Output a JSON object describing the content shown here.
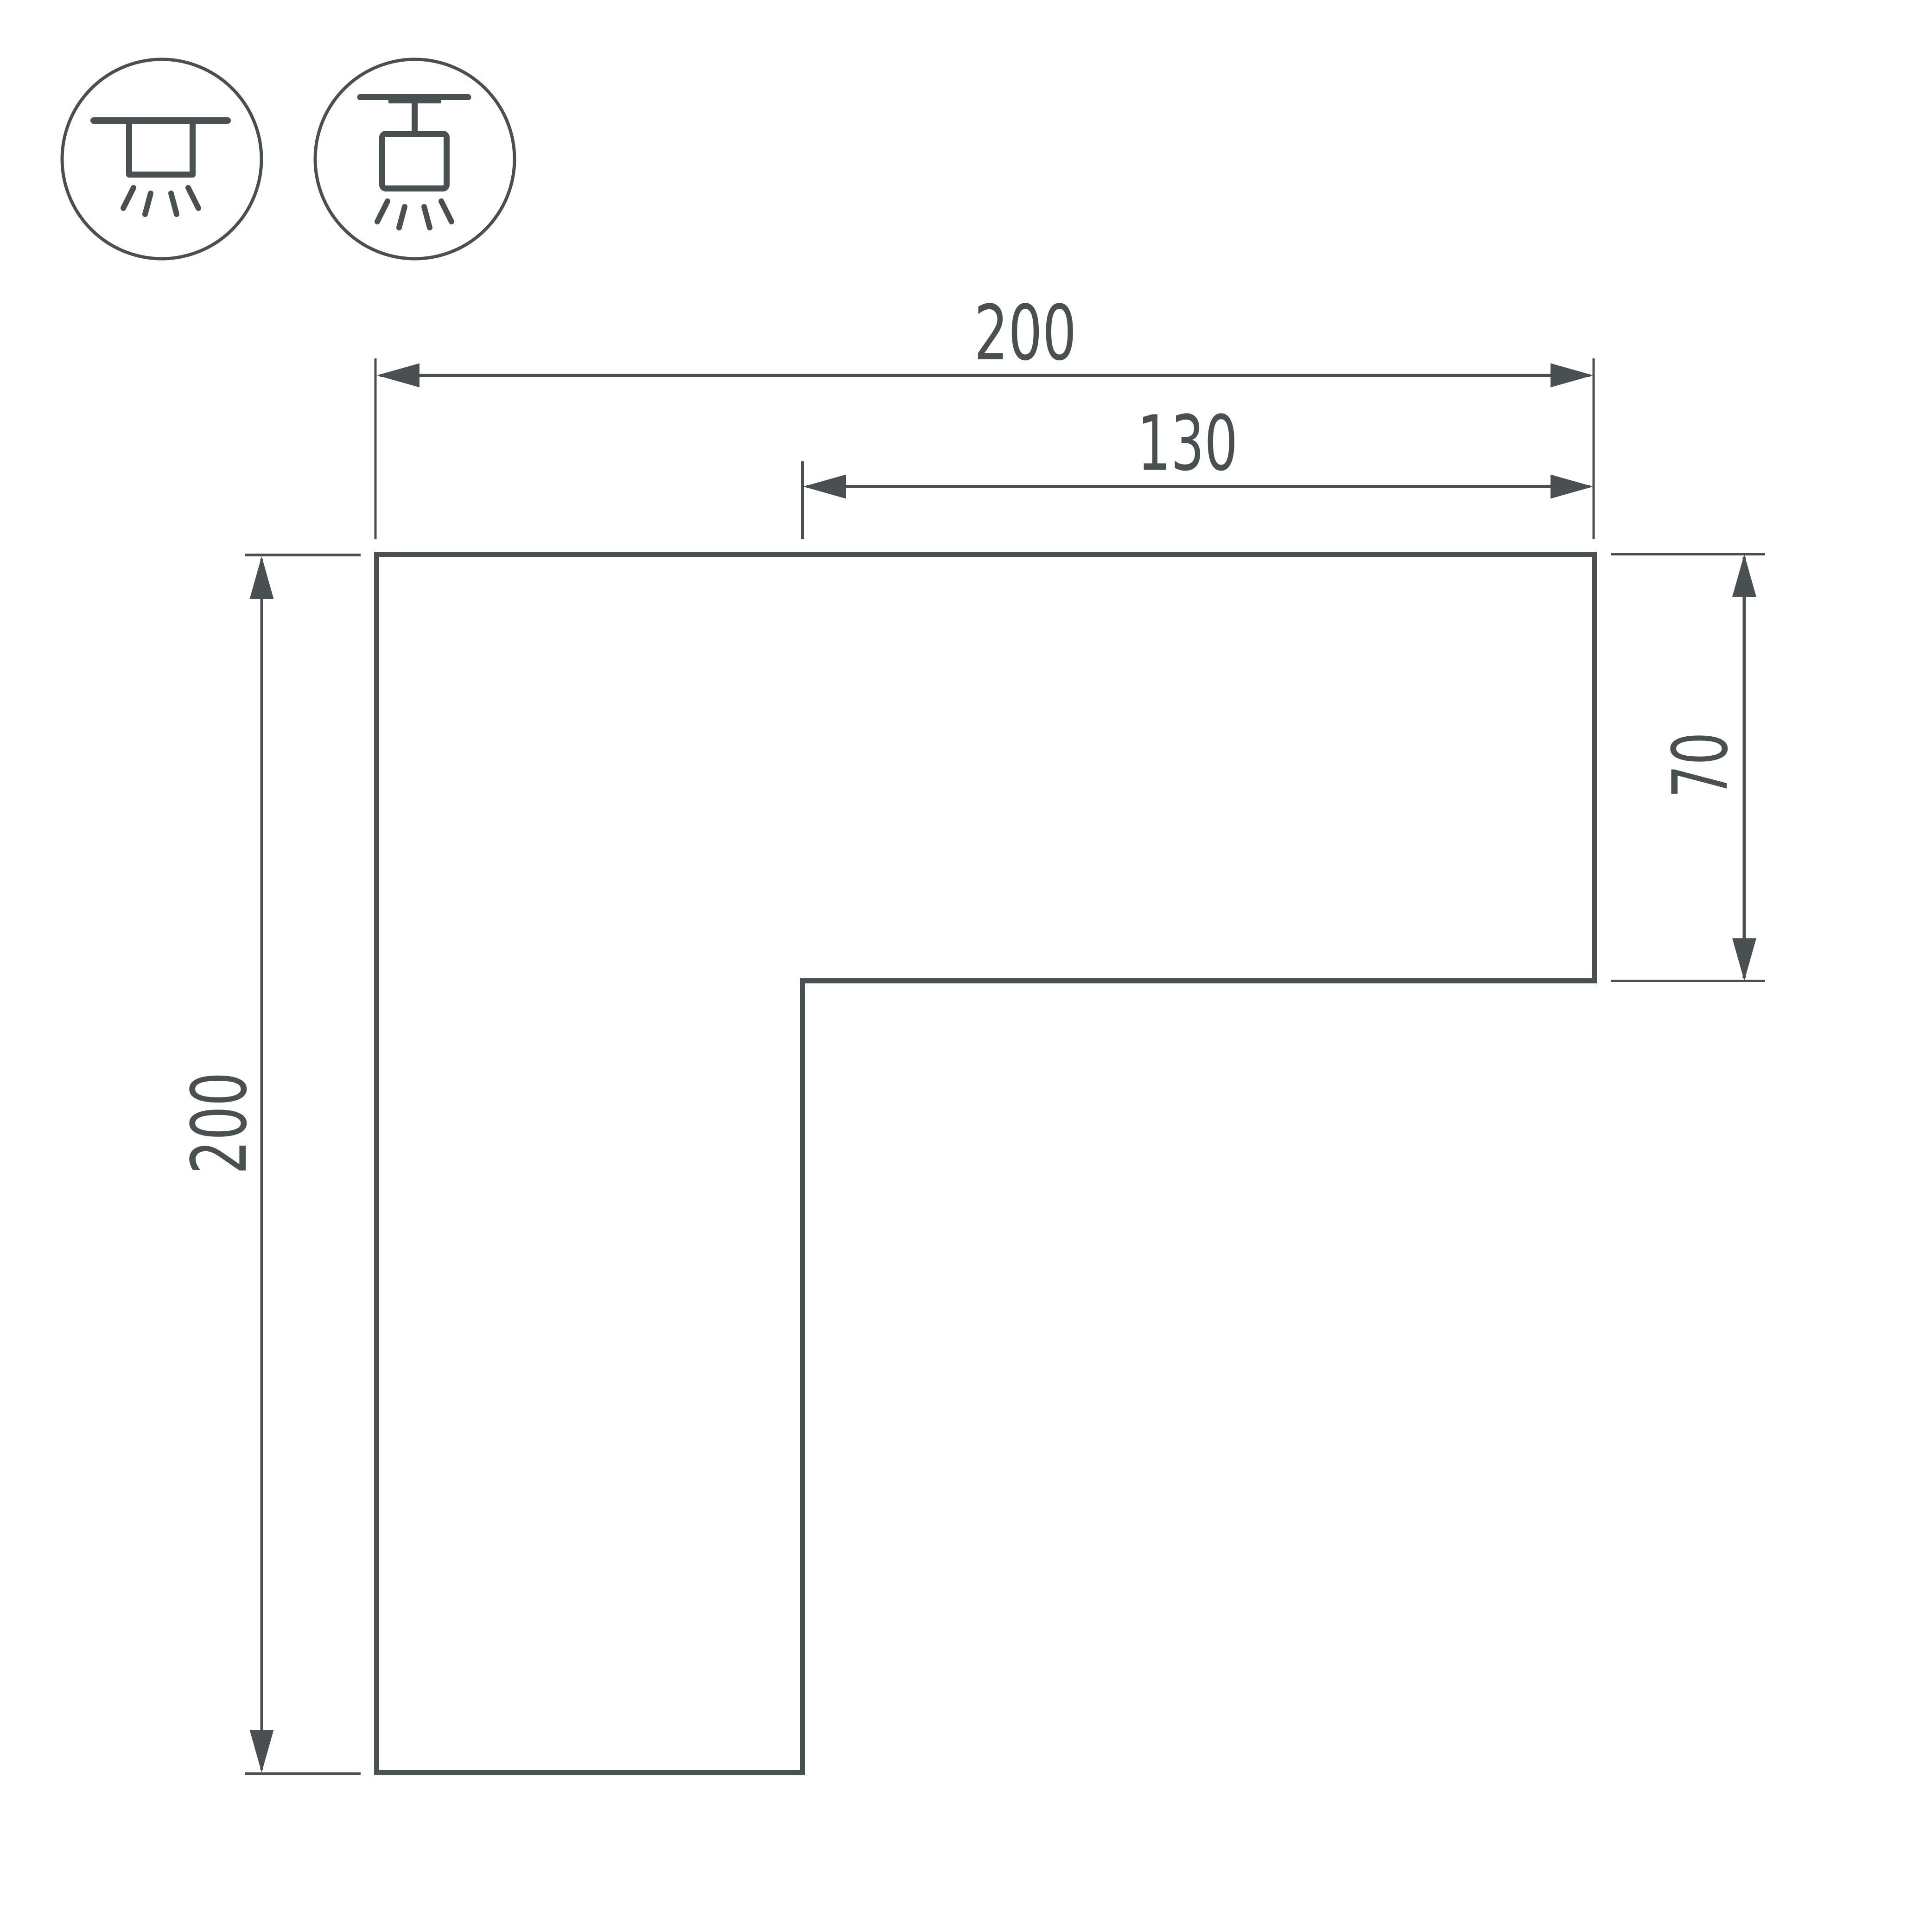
{
  "style": {
    "background": "#ffffff",
    "line_color": "#4a4f52"
  },
  "icons": [
    {
      "id": "surface-mount-icon",
      "meaning": "ceiling surface-mounted luminaire symbol"
    },
    {
      "id": "pendant-mount-icon",
      "meaning": "track-suspended pendant luminaire symbol"
    }
  ],
  "dimensions": {
    "top_width": {
      "value": "200"
    },
    "inner_width": {
      "value": "130"
    },
    "right_height": {
      "value": "70"
    },
    "left_height": {
      "value": "200"
    }
  }
}
